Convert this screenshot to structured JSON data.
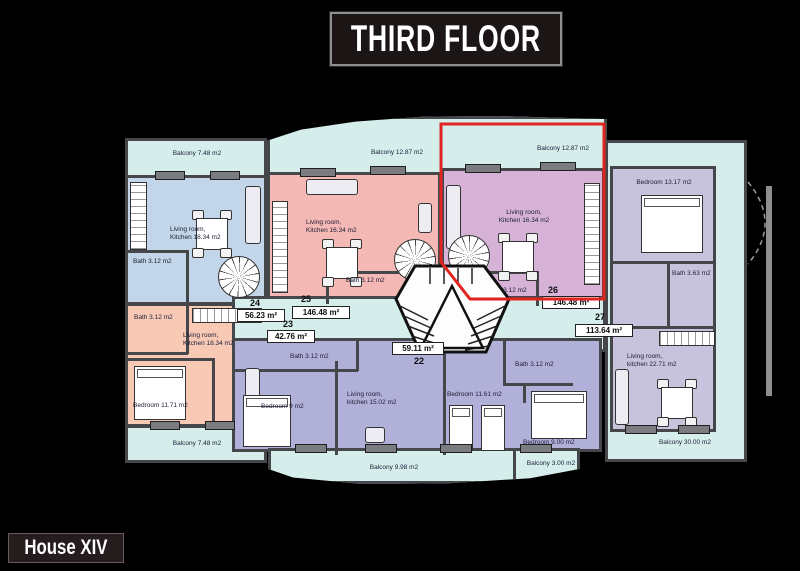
{
  "header": {
    "title": "THIRD FLOOR"
  },
  "footer": {
    "house": "House XIV"
  },
  "colors": {
    "background": "#000000",
    "common": "#d5eeec",
    "apt24": "#c3d5e8",
    "apt25": "#f4b8b5",
    "apt26": "#d5b2d6",
    "apt23": "#f8cab5",
    "apt22": "#b1b0d8",
    "apt27rooms": "#c7c3dd",
    "walls": "#46474b",
    "highlight": "#e02420"
  },
  "apartments": {
    "a22": {
      "number": "22",
      "area": "59.11 m²",
      "bath": "Bath 3.12 m2",
      "bedroom": "Bedroom 9 m2",
      "living": "Living room,\nkitchen 15.02 m2",
      "balcony": "Balcony 9.98 m2"
    },
    "a23": {
      "number": "23",
      "area": "42.76 m²",
      "bath": "Bath 3.12 m2",
      "living": "Living room,\nKitchen 18.34 m2",
      "bedroom": "Bedroom 11.71 m2",
      "balcony": "Balcony 7.48 m2"
    },
    "a24": {
      "number": "24",
      "area": "56.23 m²",
      "living": "Living room,\nKitchen 18.34 m2",
      "bath": "Bath 3.12 m2",
      "balcony": "Balcony 7.48 m2"
    },
    "a25": {
      "number": "25",
      "area": "146.48 m²",
      "living": "Living room,\nKitchen 16.34 m2",
      "bath": "Bath 3.12 m2",
      "balcony": "Balcony 12.87 m2"
    },
    "a26": {
      "number": "26",
      "area": "146.48 m²",
      "living": "Living room,\nKitchen 16.34 m2",
      "bath": "Bath 3.12 m2",
      "balcony": "Balcony 12.87 m2",
      "highlighted": true
    },
    "a27": {
      "number": "27",
      "area": "113.64 m²",
      "bedroom1": "Bedroom 13.17 m2",
      "bath1": "Bath 3.63 m2",
      "living": "Living room,\nkitchen 22.71 m2",
      "bedroom2": "Bedroom 11.61 m2",
      "bath2": "Bath 3.12 m2",
      "bedroom3": "Bedroom 9.00 m2",
      "balcony1": "Balcony 3.00 m2",
      "balcony2": "Balcony 30.00 m2"
    }
  }
}
